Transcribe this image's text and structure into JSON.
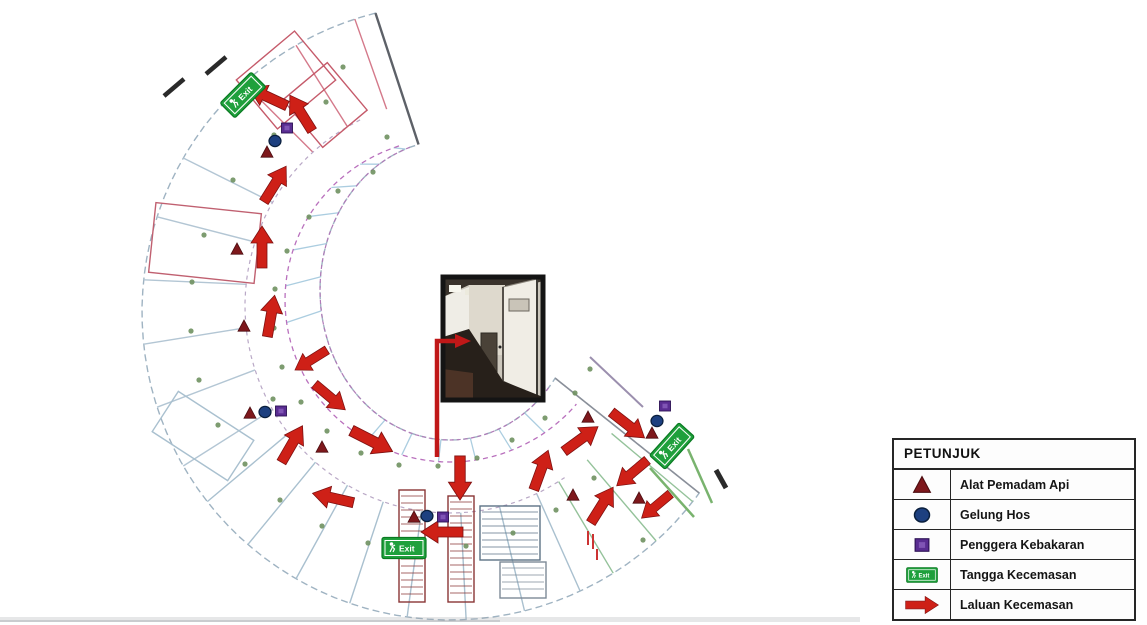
{
  "legend": {
    "title": "PETUNJUK",
    "items": [
      {
        "icon": "extinguisher-triangle-icon",
        "label": "Alat Pemadam Api"
      },
      {
        "icon": "hose-reel-icon",
        "label": "Gelung Hos"
      },
      {
        "icon": "fire-alarm-icon",
        "label": "Penggera Kebakaran"
      },
      {
        "icon": "exit-stair-icon",
        "label": "Tangga Kecemasan"
      },
      {
        "icon": "route-arrow-icon",
        "label": "Laluan Kecemasan"
      }
    ]
  },
  "exit_sign_text": "Exit",
  "colors": {
    "arrow": "#ce2017",
    "arrow_dark": "#7e1010",
    "extinguisher": "#7e181c",
    "hose": "#1d4080",
    "hose_border": "#0a1f3d",
    "alarm": "#5a2d92",
    "alarm_inner": "#8055b5",
    "alarm_border": "#2c1154",
    "exit_green": "#1fa03c",
    "exit_border": "#0a7a22",
    "outline": "#9fb3c2",
    "cap": "#5d6168",
    "corridor": "#b970bd",
    "corridor2": "#b9a8c6",
    "dots": "#6f9160",
    "stair": "#8a3535",
    "callout": "#c01818"
  },
  "plan": {
    "outer": {
      "cx": 450,
      "cy": 312,
      "rx": 308,
      "ry": 308
    },
    "inner": {
      "cx": 450,
      "cy": 290,
      "rx": 130,
      "ry": 150
    },
    "corridor_inner": {
      "cx": 450,
      "cy": 300,
      "rx": 165,
      "ry": 162
    },
    "corridor_outer": {
      "cx": 450,
      "cy": 306,
      "rx": 205,
      "ry": 207
    },
    "start_angle": 256,
    "end_angle": 36,
    "outer_wall_zones": [
      {
        "from": 252,
        "to": 218,
        "step": 12,
        "color": "#d4798a"
      },
      {
        "from": 210,
        "to": 150,
        "step": 12,
        "color": "#b3c6d4"
      },
      {
        "from": 142,
        "to": 64,
        "step": 11,
        "color": "#a9c0cf"
      },
      {
        "from": 58,
        "to": 38,
        "step": 10,
        "color": "#94c29a"
      }
    ],
    "inner_wall_zones": [
      {
        "from": 250,
        "to": 162,
        "step": 13,
        "color": "#abcde0"
      },
      {
        "from": 120,
        "to": 52,
        "step": 13,
        "color": "#abcde0"
      }
    ]
  },
  "floorplan": {
    "arrows": [
      {
        "x": 268,
        "y": 97,
        "angle": 205,
        "s": 1
      },
      {
        "x": 301,
        "y": 113,
        "angle": -122,
        "s": 1
      },
      {
        "x": 275,
        "y": 184,
        "angle": -58,
        "s": 1
      },
      {
        "x": 262,
        "y": 247,
        "angle": -90,
        "s": 1
      },
      {
        "x": 271,
        "y": 316,
        "angle": -80,
        "s": 1
      },
      {
        "x": 311,
        "y": 360,
        "angle": 148,
        "s": 0.9
      },
      {
        "x": 330,
        "y": 397,
        "angle": 40,
        "s": 0.95
      },
      {
        "x": 292,
        "y": 444,
        "angle": -60,
        "s": 1
      },
      {
        "x": 372,
        "y": 441,
        "angle": 27,
        "s": 1.1
      },
      {
        "x": 333,
        "y": 498,
        "angle": 193,
        "s": 1
      },
      {
        "x": 460,
        "y": 478,
        "angle": 90,
        "s": 1.05
      },
      {
        "x": 442,
        "y": 532,
        "angle": 180,
        "s": 1
      },
      {
        "x": 541,
        "y": 470,
        "angle": -70,
        "s": 1
      },
      {
        "x": 581,
        "y": 439,
        "angle": -36,
        "s": 1
      },
      {
        "x": 628,
        "y": 425,
        "angle": 38,
        "s": 1
      },
      {
        "x": 632,
        "y": 473,
        "angle": 140,
        "s": 0.95
      },
      {
        "x": 602,
        "y": 505,
        "angle": -58,
        "s": 1
      },
      {
        "x": 656,
        "y": 506,
        "angle": 140,
        "s": 0.9
      }
    ],
    "extinguishers": [
      {
        "x": 267,
        "y": 152
      },
      {
        "x": 237,
        "y": 249
      },
      {
        "x": 244,
        "y": 326
      },
      {
        "x": 250,
        "y": 413
      },
      {
        "x": 322,
        "y": 447
      },
      {
        "x": 414,
        "y": 517
      },
      {
        "x": 573,
        "y": 495
      },
      {
        "x": 639,
        "y": 498
      },
      {
        "x": 652,
        "y": 433
      },
      {
        "x": 588,
        "y": 417
      }
    ],
    "hoses": [
      {
        "x": 275,
        "y": 141
      },
      {
        "x": 265,
        "y": 412
      },
      {
        "x": 427,
        "y": 516
      },
      {
        "x": 657,
        "y": 421
      }
    ],
    "alarms": [
      {
        "x": 287,
        "y": 128
      },
      {
        "x": 281,
        "y": 411
      },
      {
        "x": 443,
        "y": 517
      },
      {
        "x": 665,
        "y": 406
      }
    ],
    "exit_signs": [
      {
        "x": 243,
        "y": 95,
        "angle": -45
      },
      {
        "x": 404,
        "y": 548,
        "angle": 0
      },
      {
        "x": 672,
        "y": 446,
        "angle": -48
      }
    ],
    "photo": {
      "x": 443,
      "y": 277,
      "w": 100,
      "h": 123
    },
    "callout": {
      "line": [
        [
          437,
          457
        ],
        [
          437,
          341
        ],
        [
          456,
          341
        ]
      ],
      "head": [
        [
          455,
          334
        ],
        [
          471,
          341
        ],
        [
          455,
          348
        ]
      ]
    },
    "door_dots": [
      [
        373,
        172
      ],
      [
        338,
        191
      ],
      [
        309,
        217
      ],
      [
        287,
        251
      ],
      [
        275,
        289
      ],
      [
        274,
        328
      ],
      [
        282,
        367
      ],
      [
        301,
        402
      ],
      [
        327,
        431
      ],
      [
        361,
        453
      ],
      [
        399,
        465
      ],
      [
        438,
        466
      ],
      [
        477,
        458
      ],
      [
        512,
        440
      ],
      [
        545,
        418
      ],
      [
        575,
        393
      ],
      [
        273,
        399
      ],
      [
        326,
        102
      ],
      [
        274,
        135
      ],
      [
        233,
        180
      ],
      [
        204,
        235
      ],
      [
        192,
        282
      ],
      [
        191,
        331
      ],
      [
        199,
        380
      ],
      [
        218,
        425
      ],
      [
        245,
        464
      ],
      [
        280,
        500
      ],
      [
        322,
        526
      ],
      [
        368,
        543
      ],
      [
        417,
        550
      ],
      [
        466,
        546
      ],
      [
        513,
        533
      ],
      [
        556,
        510
      ],
      [
        594,
        478
      ],
      [
        590,
        369
      ],
      [
        643,
        540
      ],
      [
        343,
        67
      ],
      [
        387,
        137
      ]
    ],
    "detail_rects": [
      {
        "x": 248,
        "y": 48,
        "w": 76,
        "h": 64,
        "a": -40,
        "stroke": "#c55a6a"
      },
      {
        "x": 296,
        "y": 74,
        "w": 58,
        "h": 62,
        "a": -40,
        "stroke": "#c55a6a"
      },
      {
        "x": 152,
        "y": 208,
        "w": 106,
        "h": 70,
        "a": 6,
        "stroke": "#c06070"
      },
      {
        "x": 158,
        "y": 412,
        "w": 90,
        "h": 48,
        "a": 33,
        "stroke": "#a9c0cf"
      },
      {
        "x": 399,
        "y": 490,
        "w": 26,
        "h": 112,
        "a": 0,
        "stroke": "#8a3535",
        "hatch": true
      },
      {
        "x": 448,
        "y": 496,
        "w": 26,
        "h": 106,
        "a": 0,
        "stroke": "#8a3535",
        "hatch": true
      },
      {
        "x": 480,
        "y": 506,
        "w": 60,
        "h": 54,
        "a": 0,
        "stroke": "#5d7386",
        "hatch": true
      },
      {
        "x": 500,
        "y": 562,
        "w": 46,
        "h": 36,
        "a": 0,
        "stroke": "#7d8a97",
        "hatch": true
      }
    ],
    "detail_lines": [
      {
        "p": [
          [
            590,
            357
          ],
          [
            643,
            407
          ]
        ],
        "c": "#9b8fae",
        "w": 2
      },
      {
        "p": [
          [
            688,
            449
          ],
          [
            712,
            503
          ]
        ],
        "c": "#79b36e",
        "w": 2.5
      },
      {
        "p": [
          [
            650,
            468
          ],
          [
            694,
            517
          ]
        ],
        "c": "#79b36e",
        "w": 2.5
      },
      {
        "p": [
          [
            716,
            470
          ],
          [
            726,
            488
          ]
        ],
        "c": "#2a2a2a",
        "w": 5
      },
      {
        "p": [
          [
            206,
            74
          ],
          [
            226,
            57
          ]
        ],
        "c": "#2a2a2a",
        "w": 4.5
      },
      {
        "p": [
          [
            164,
            96
          ],
          [
            184,
            79
          ]
        ],
        "c": "#2a2a2a",
        "w": 4.5
      },
      {
        "p": [
          [
            588,
            531
          ],
          [
            588,
            545
          ]
        ],
        "c": "#cc3333",
        "w": 2
      },
      {
        "p": [
          [
            593,
            534
          ],
          [
            593,
            549
          ]
        ],
        "c": "#cc3333",
        "w": 2
      },
      {
        "p": [
          [
            597,
            549
          ],
          [
            597,
            560
          ]
        ],
        "c": "#cc3333",
        "w": 2
      }
    ]
  }
}
